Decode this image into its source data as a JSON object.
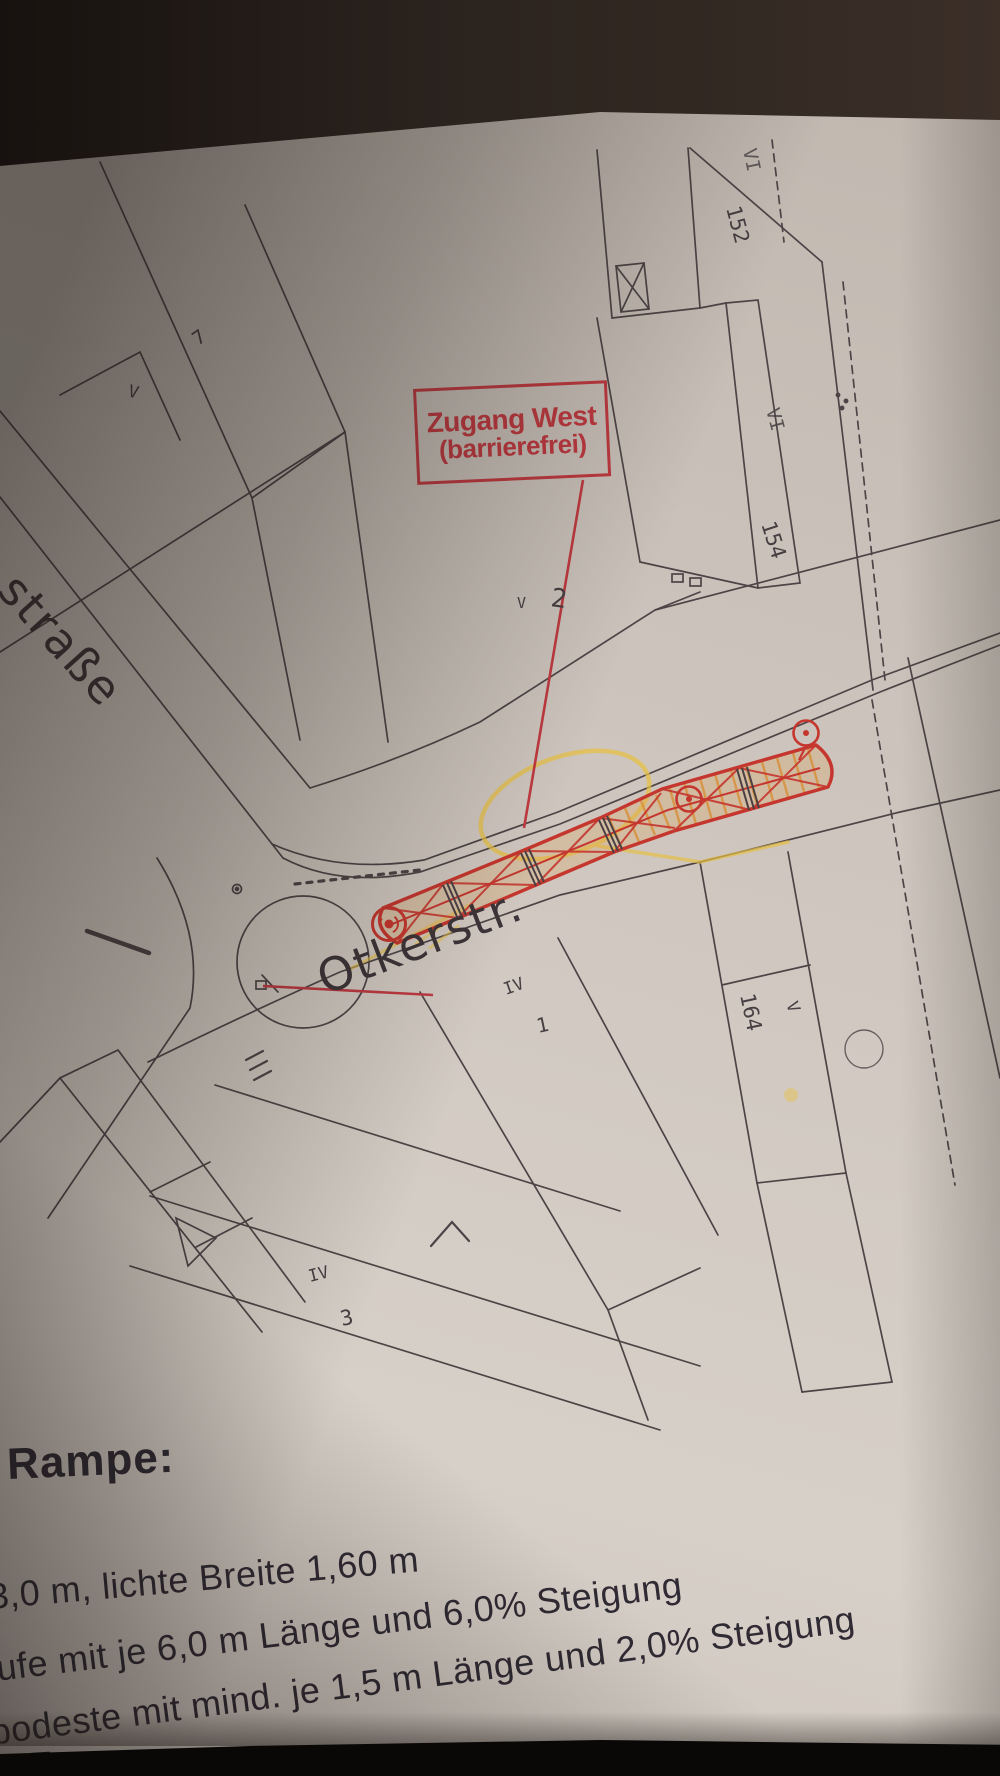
{
  "annotation_box": {
    "line1": "Zugang West",
    "line2": "(barrierefrei)"
  },
  "streets": {
    "otkerstrasse": "Otkerstr.",
    "left_street_partial": "straße"
  },
  "plan_labels": {
    "building_152": "152",
    "floors_vi_top": "VI",
    "building_154": "154",
    "floors_vi_mid": "VI",
    "house_2": "2",
    "plot_7": "7",
    "mark_v_upper": "V",
    "mark_v_mid": "V",
    "floors_iv_upper": "IV",
    "house_1": "1",
    "building_164": "164",
    "floors_v_right": "V",
    "floors_iv_lower": "IV",
    "house_3": "3"
  },
  "ramp_notes": {
    "heading": "Rampe:",
    "line1": "3,0 m, lichte Breite 1,60 m",
    "line2": "ufe mit je 6,0 m Länge und 6,0% Steigung",
    "line3": "podeste mit mind. je 1,5 m Länge und 2,0% Steigung",
    "partial_next_line": "T"
  },
  "colors": {
    "annotation_red": "#bf3940",
    "ramp_red": "#c5362e",
    "highlighter_yellow": "#e6bf45",
    "hatch_orange": "#d9913d",
    "ink": "#4e4447",
    "paper": "#cfc7c0"
  }
}
